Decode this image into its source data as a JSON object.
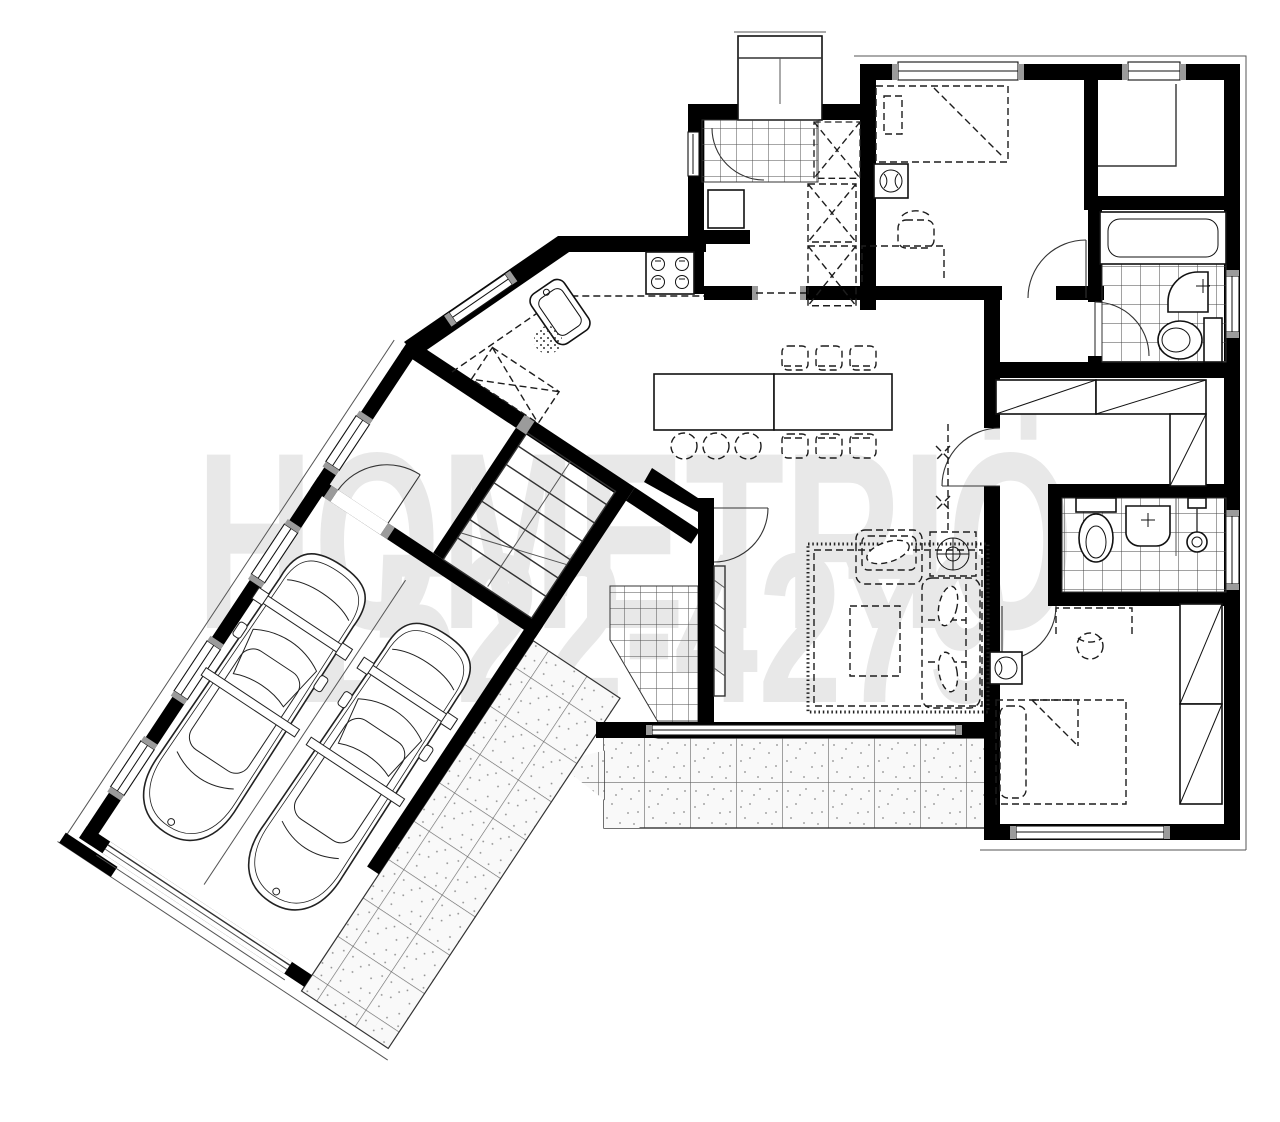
{
  "image": {
    "width": 1280,
    "height": 1122,
    "background": "#ffffff"
  },
  "watermark": {
    "line1": "HOMETRIÖ",
    "line2": "1522-4279",
    "color": "#e8e8e8"
  },
  "palette": {
    "wall_black": "#000000",
    "furniture_line": "#1d1d1d",
    "accent_gray": "#9b9b9b",
    "tile_line": "#4f4f4f",
    "patio_fill": "#f7f7f7",
    "patio_dot": "#8d8d8d",
    "paper": "#ffffff"
  },
  "plan": {
    "type": "single-storey-house-floor-plan",
    "rooms": [
      "entry-porch",
      "entry-vestibule",
      "hall-closets",
      "master-bedroom",
      "walk-in-closet",
      "bathroom-1",
      "dressing-hall",
      "bathroom-2",
      "bedroom-2",
      "living-room",
      "kitchen",
      "dining-area",
      "staircase",
      "mudroom",
      "garage",
      "rear-foyer",
      "patio-terrace"
    ],
    "fixtures": [
      "double-bed",
      "single-bed",
      "desk-and-chair",
      "wardrobes",
      "bathtub",
      "wash-basin",
      "toilet",
      "shower-head",
      "kitchen-sink",
      "cooktop-4-burner",
      "kitchen-island",
      "bar-stools",
      "dining-table-6-chairs",
      "sofa",
      "armchair",
      "coffee-table",
      "area-rug",
      "side-table-lamp",
      "two-cars",
      "garage-door",
      "windows",
      "door-swings"
    ]
  }
}
